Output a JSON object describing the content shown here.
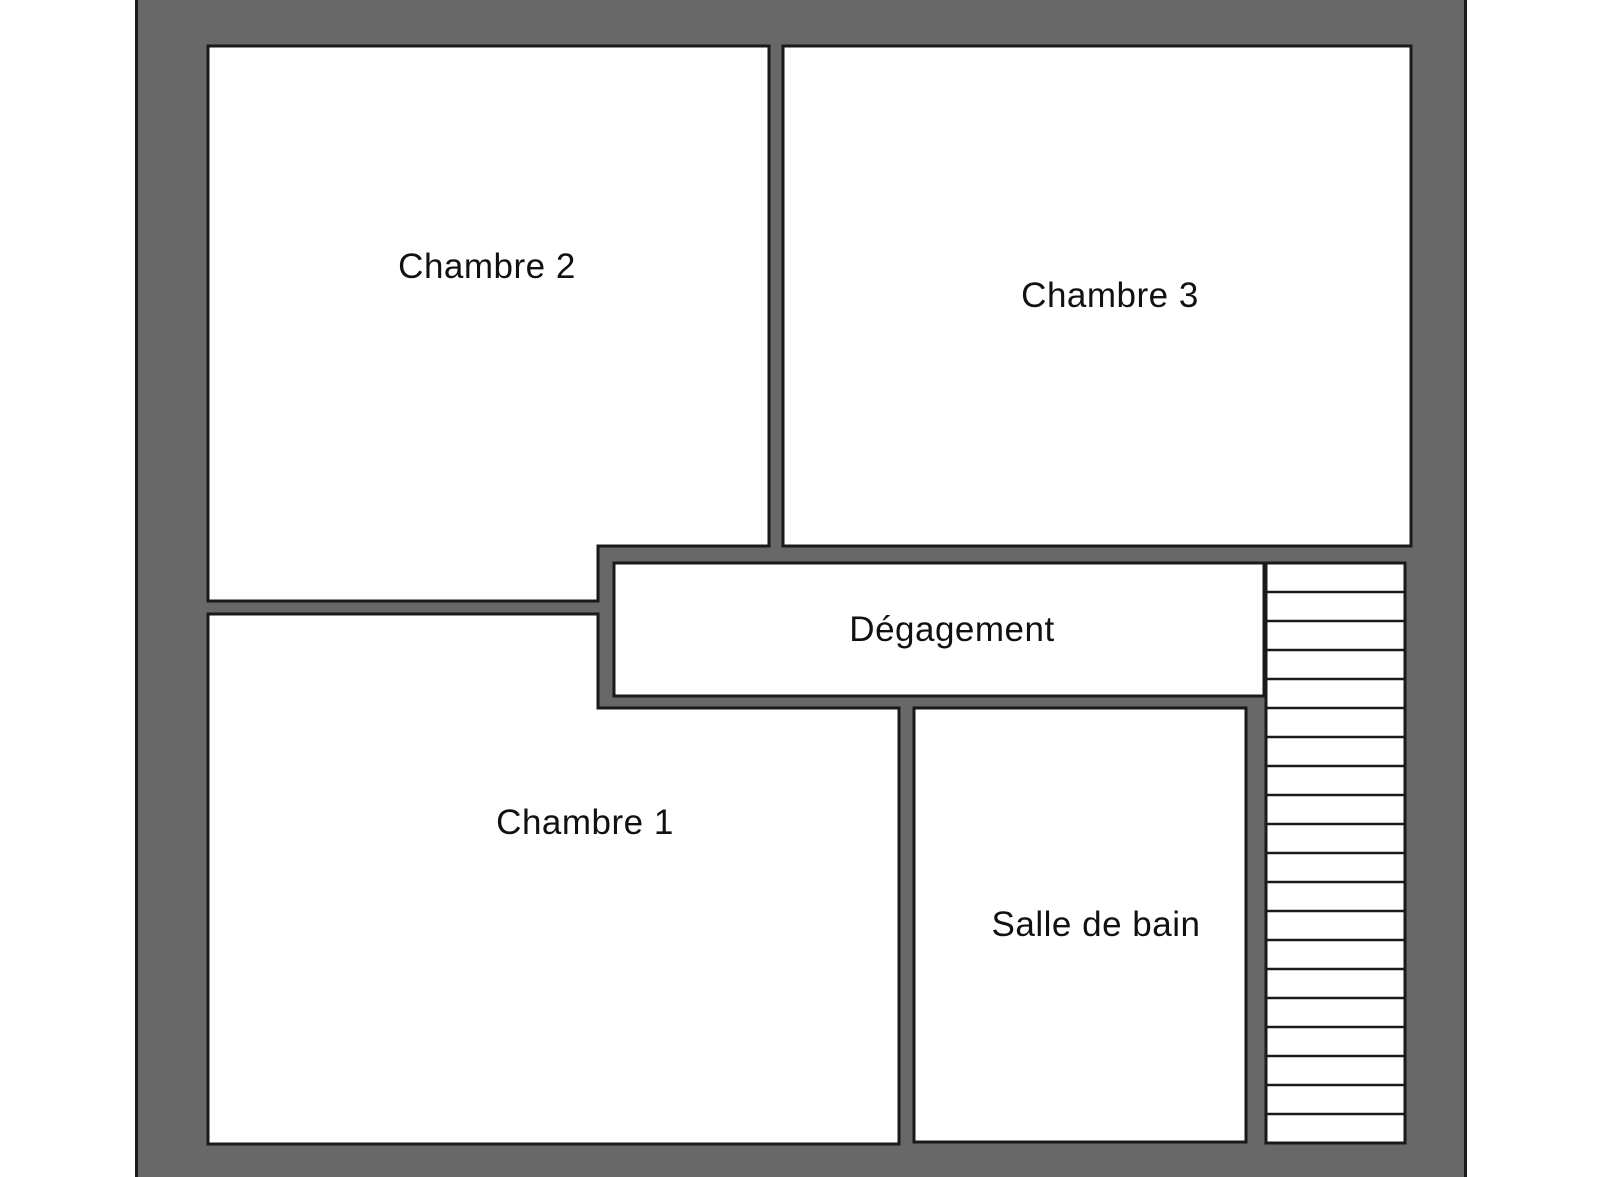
{
  "floor_plan": {
    "rooms": [
      {
        "id": "chambre-2",
        "label": "Chambre 2"
      },
      {
        "id": "chambre-3",
        "label": "Chambre 3"
      },
      {
        "id": "degagement",
        "label": "Dégagement"
      },
      {
        "id": "chambre-1",
        "label": "Chambre 1"
      },
      {
        "id": "salle-de-bain",
        "label": "Salle de bain"
      }
    ],
    "stairs": {
      "name": "staircase",
      "step_count": 20
    },
    "colors": {
      "wall_fill": "#686868",
      "line": "#1a1a1a",
      "room_fill": "#ffffff",
      "background": "#ffffff",
      "text": "#111111"
    }
  }
}
